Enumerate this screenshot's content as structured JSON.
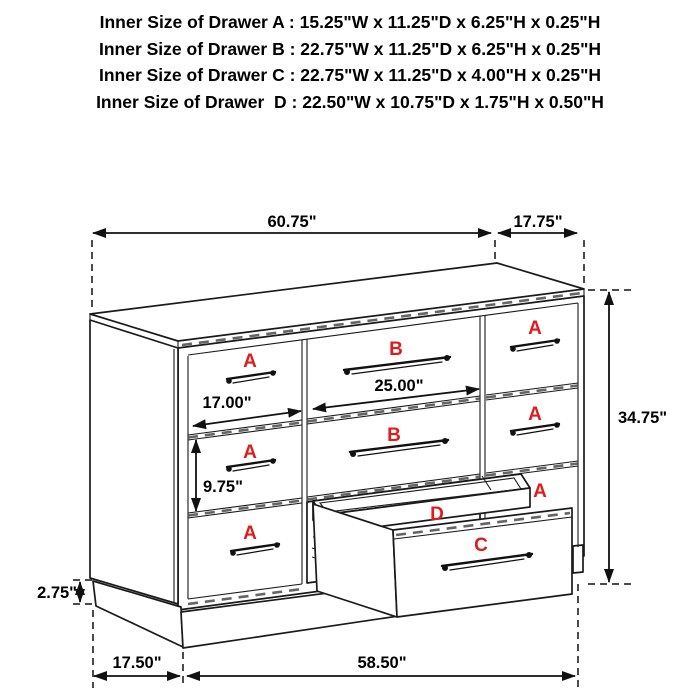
{
  "header": {
    "lines": [
      "Inner Size of Drawer A : 15.25\"W x 11.25\"D x 6.25\"H x 0.25\"H",
      "Inner Size of Drawer B : 22.75\"W x 11.25\"D x 6.25\"H x 0.25\"H",
      "Inner Size of Drawer C : 22.75\"W x 11.25\"D x 4.00\"H x 0.25\"H",
      "Inner Size of Drawer  D : 22.50\"W x 10.75\"D x 1.75\"H x 0.50\"H"
    ]
  },
  "diagram": {
    "drawer_letters": {
      "a": "A",
      "b": "B",
      "c": "C",
      "d": "D"
    },
    "dimensions": {
      "top_width": "60.75\"",
      "top_depth": "17.75\"",
      "overall_height": "34.75\"",
      "left_drawer_width": "17.00\"",
      "middle_drawer_width": "25.00\"",
      "left_drawer_height": "9.75\"",
      "base_height": "2.75\"",
      "base_depth": "17.50\"",
      "base_width": "58.50\""
    },
    "colors": {
      "line": "#1a1a1a",
      "drawer_label_red": "#e01b1b",
      "background": "#ffffff"
    }
  }
}
